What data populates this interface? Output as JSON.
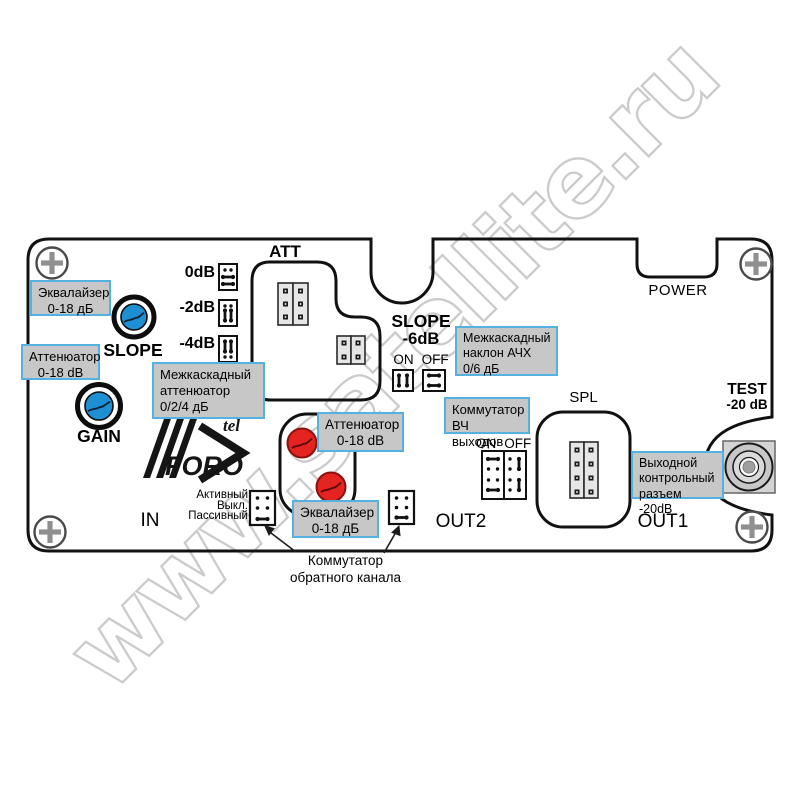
{
  "watermark": {
    "text": "www.satellite.ru"
  },
  "logo": {
    "brand": "FORO",
    "suffix": "tel"
  },
  "labels": {
    "att": "ATT",
    "power": "POWER",
    "spl": "SPL",
    "in": "IN",
    "out1": "OUT1",
    "out2": "OUT2",
    "test_title": "TEST",
    "test_level": "-20 dB"
  },
  "controls": {
    "slope_knob": "SLOPE",
    "gain_knob": "GAIN",
    "interstage_att_options": [
      "0dB",
      "-2dB",
      "-4dB"
    ],
    "slope6": {
      "line1": "SLOPE",
      "line2": "-6dB",
      "on": "ON",
      "off": "OFF"
    },
    "rf_switch": {
      "on": "ON",
      "off": "OFF"
    },
    "return_switch": {
      "modes": [
        "Активный",
        "Выкл.",
        "Пассивный"
      ],
      "caption": [
        "Коммутатор",
        "обратного канала"
      ]
    }
  },
  "callouts": {
    "equalizer_fwd": {
      "lines": [
        "Эквалайзер",
        "0-18 дБ"
      ]
    },
    "attenuator_fwd": {
      "lines": [
        "Аттенюатор",
        "0-18 dB"
      ]
    },
    "interstage_att": {
      "lines": [
        "Межкаскадный",
        "аттенюатор",
        "0/2/4 дБ"
      ]
    },
    "interstage_slope": {
      "lines": [
        "Межкаскадный",
        "наклон АЧХ",
        "0/6 дБ"
      ]
    },
    "rf_out_switch": {
      "lines": [
        "Коммутатор",
        "ВЧ выходов"
      ]
    },
    "attenuator_ret": {
      "lines": [
        "Аттенюатор",
        "0-18 dB"
      ]
    },
    "equalizer_ret": {
      "lines": [
        "Эквалайзер",
        "0-18 дБ"
      ]
    },
    "output_test": {
      "lines": [
        "Выходной",
        "контрольный",
        "разъем -20dB"
      ]
    }
  },
  "colors": {
    "knob_blue": "#1e8fd2",
    "knob_red": "#e32421",
    "callout_bg": "#c7c7c7",
    "callout_border": "#55b1e0",
    "watermark": "#c9c9c9"
  }
}
